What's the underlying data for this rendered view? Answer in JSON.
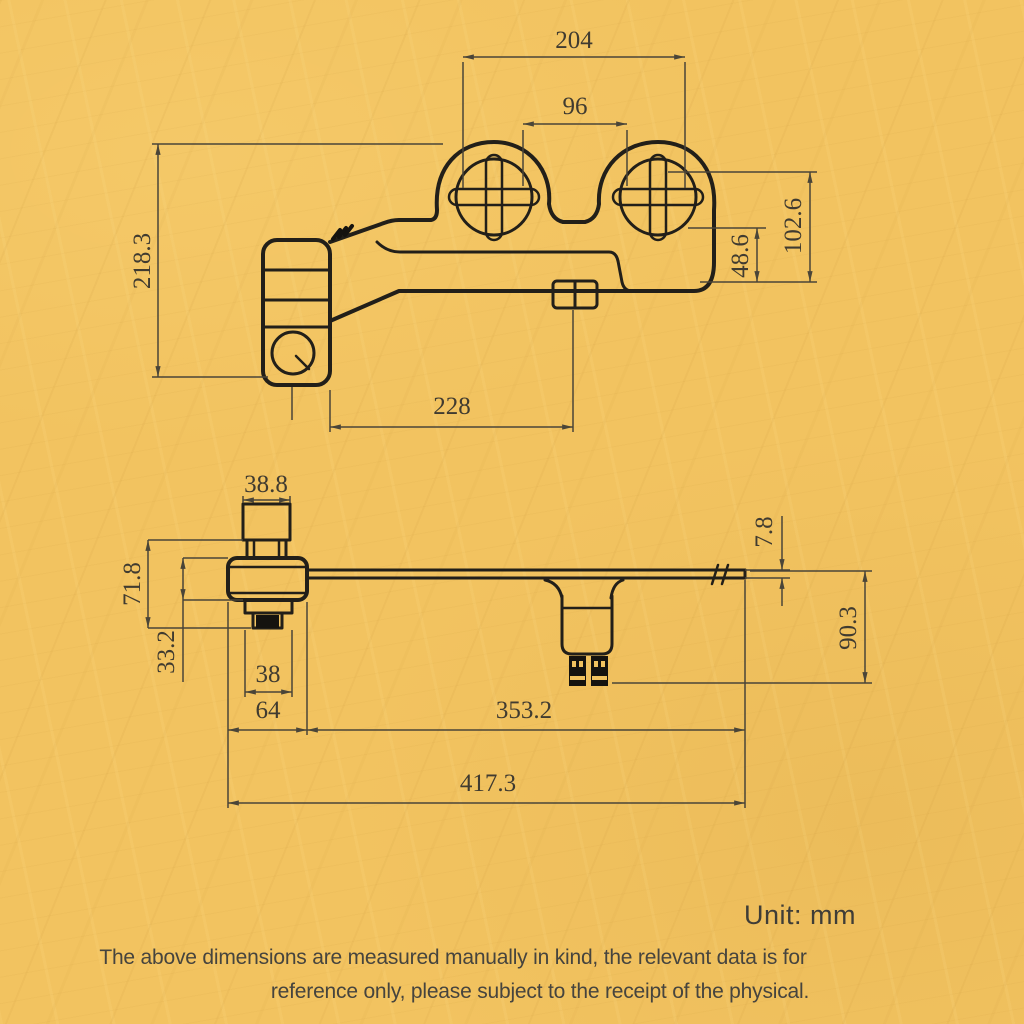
{
  "colors": {
    "background": "#f2c360",
    "line": "#221f19",
    "dimension": "#403b30"
  },
  "top_view": {
    "dim_outer_width": "204",
    "dim_inner_width": "96",
    "dim_total_height": "218.3",
    "dim_bracket_height": "48.6",
    "dim_right_height": "102.6",
    "dim_body_length": "228"
  },
  "side_view": {
    "dim_valve_top_width": "38.8",
    "dim_valve_height": "71.8",
    "dim_flange_height": "33.2",
    "dim_gasket_width": "38",
    "dim_left_offset": "64",
    "dim_arm_length": "353.2",
    "dim_total_length": "417.3",
    "dim_plate_thickness": "7.8",
    "dim_nozzle_drop": "90.3"
  },
  "footer": {
    "unit_label": "Unit: mm",
    "disclaimer_line1": "The above dimensions are measured manually in kind, the relevant data is for",
    "disclaimer_line2": "reference only, please subject to the receipt of the physical."
  }
}
